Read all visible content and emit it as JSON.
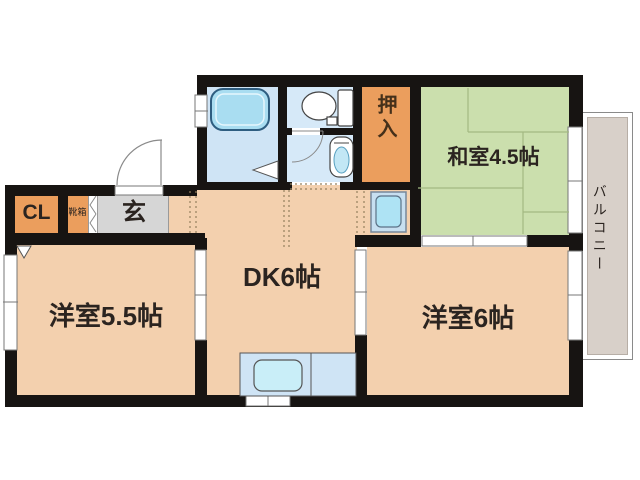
{
  "floorplan": {
    "labels": {
      "cl": "CL",
      "shoe_box": "靴箱",
      "entrance": "玄",
      "oshiire": "押入",
      "japanese_room": "和室4.5帖",
      "dining_kitchen": "DK6帖",
      "western_room_small": "洋室5.5帖",
      "western_room_large": "洋室6帖",
      "balcony": "バルコニー"
    },
    "room_types": {
      "japanese_room": "tatami",
      "dining_kitchen": "dk",
      "western_room_small": "western",
      "western_room_large": "western"
    },
    "fixtures": [
      "bathtub",
      "toilet",
      "washbasin",
      "kitchen-sink",
      "washing-machine-pan",
      "entry-door",
      "bath-door",
      "washroom-door"
    ],
    "colors": {
      "room_peach": "#f3d0ae",
      "closet_orange": "#eb9e5d",
      "tatami_green": "#cbdfad",
      "wet_room_blue": "#d6e9f8",
      "bath_blue": "#cfe4f5",
      "fixture_blue": "#abdff2",
      "entrance_gray": "#d6d6d6",
      "balcony_gray": "#d8d0c9",
      "wall_black": "#171412"
    }
  }
}
